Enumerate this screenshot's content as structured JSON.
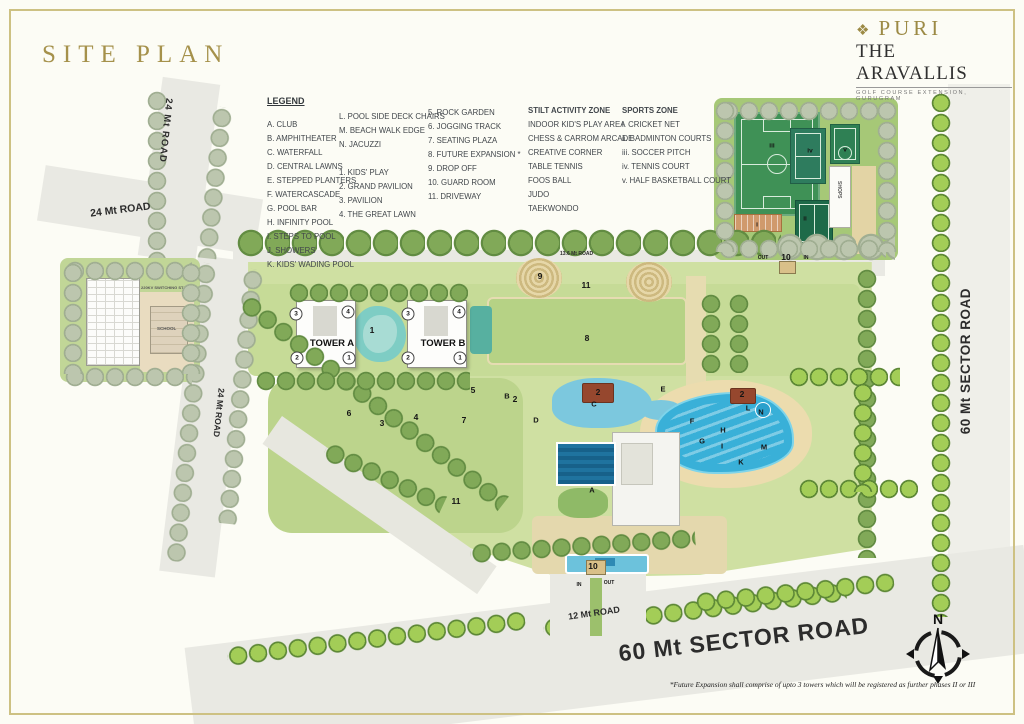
{
  "page": {
    "title": "SITE PLAN"
  },
  "brand": {
    "name": "PURI",
    "project": "THE ARAVALLIS",
    "tagline": "GOLF COURSE EXTENSION, GURUGRAM",
    "diamond": "❖"
  },
  "legend": {
    "title": "LEGEND",
    "col_letters": [
      "A. CLUB",
      "B. AMPHITHEATER",
      "C. WATERFALL",
      "D. CENTRAL LAWNS",
      "E. STEPPED PLANTERS",
      "F. WATERCASCADE",
      "G. POOL BAR",
      "H. INFINITY POOL",
      "I. STEPS TO POOL",
      "J. SHOWERS",
      "K. KIDS' WADING POOL"
    ],
    "col_letters2": [
      "L. POOL SIDE  DECK CHAIRS",
      "M. BEACH WALK EDGE",
      "N. JACUZZI"
    ],
    "col_numbers1": [
      "1.  KIDS' PLAY",
      "2.  GRAND PAVILION",
      "3.  PAVILION",
      "4.  THE GREAT LAWN"
    ],
    "col_numbers2": [
      "5.  ROCK GARDEN",
      "6.  JOGGING TRACK",
      "7.  SEATING PLAZA",
      "8.  FUTURE EXPANSION *",
      "9.  DROP OFF",
      "10. GUARD ROOM",
      "11. DRIVEWAY"
    ],
    "stilt": {
      "title": "STILT ACTIVITY ZONE",
      "items": [
        "INDOOR KID'S PLAY AREA",
        "CHESS & CARROM ARCADE",
        "CREATIVE CORNER",
        "TABLE TENNIS",
        "FOOS BALL",
        "JUDO",
        "TAEKWONDO"
      ]
    },
    "sports": {
      "title": "SPORTS ZONE",
      "items": [
        "i.   CRICKET NET",
        "ii.  BADMINTON COURTS",
        "iii. SOCCER PITCH",
        "iv.  TENNIS COURT",
        "v.   HALF BASKETBALL COURT"
      ]
    }
  },
  "roads": {
    "r24_top": "24 Mt ROAD",
    "r24_diag": "24 Mt ROAD",
    "r24_mid": "24 Mt ROAD",
    "r60_right": "60 Mt SECTOR ROAD",
    "r60_bottom": "60 Mt SECTOR ROAD",
    "r12": "12 Mt ROAD",
    "r136": "13.6 Mt ROAD"
  },
  "map": {
    "tower_a": "TOWER A",
    "tower_b": "TOWER B",
    "shops": "SHOPS",
    "switching_station": "220KV SWITCHING STATION",
    "school": "SCHOOL",
    "markers": [
      {
        "x": 296,
        "y": 314,
        "t": "3",
        "k": "c"
      },
      {
        "x": 348,
        "y": 312,
        "t": "4",
        "k": "c"
      },
      {
        "x": 297,
        "y": 358,
        "t": "2",
        "k": "c"
      },
      {
        "x": 349,
        "y": 358,
        "t": "1",
        "k": "c"
      },
      {
        "x": 408,
        "y": 314,
        "t": "3",
        "k": "c"
      },
      {
        "x": 459,
        "y": 312,
        "t": "4",
        "k": "c"
      },
      {
        "x": 408,
        "y": 358,
        "t": "2",
        "k": "c"
      },
      {
        "x": 460,
        "y": 358,
        "t": "1",
        "k": "c"
      },
      {
        "x": 372,
        "y": 330,
        "t": "1",
        "k": "n"
      },
      {
        "x": 540,
        "y": 276,
        "t": "9",
        "k": "n"
      },
      {
        "x": 586,
        "y": 285,
        "t": "11",
        "k": "n"
      },
      {
        "x": 587,
        "y": 338,
        "t": "8",
        "k": "n"
      },
      {
        "x": 349,
        "y": 413,
        "t": "6",
        "k": "n"
      },
      {
        "x": 416,
        "y": 417,
        "t": "4",
        "k": "n"
      },
      {
        "x": 464,
        "y": 420,
        "t": "7",
        "k": "n"
      },
      {
        "x": 473,
        "y": 390,
        "t": "5",
        "k": "n"
      },
      {
        "x": 456,
        "y": 501,
        "t": "11",
        "k": "n"
      },
      {
        "x": 382,
        "y": 423,
        "t": "3",
        "k": "n"
      },
      {
        "x": 515,
        "y": 399,
        "t": "2",
        "k": "n"
      },
      {
        "x": 598,
        "y": 392,
        "t": "2",
        "k": "n"
      },
      {
        "x": 742,
        "y": 394,
        "t": "2",
        "k": "n"
      },
      {
        "x": 593,
        "y": 566,
        "t": "10",
        "k": "n"
      },
      {
        "x": 786,
        "y": 257,
        "t": "10",
        "k": "n"
      },
      {
        "x": 507,
        "y": 396,
        "t": "B",
        "k": "l"
      },
      {
        "x": 594,
        "y": 404,
        "t": "C",
        "k": "l"
      },
      {
        "x": 536,
        "y": 420,
        "t": "D",
        "k": "l"
      },
      {
        "x": 663,
        "y": 389,
        "t": "E",
        "k": "l"
      },
      {
        "x": 692,
        "y": 421,
        "t": "F",
        "k": "l"
      },
      {
        "x": 702,
        "y": 441,
        "t": "G",
        "k": "l"
      },
      {
        "x": 723,
        "y": 430,
        "t": "H",
        "k": "l"
      },
      {
        "x": 722,
        "y": 446,
        "t": "I",
        "k": "l"
      },
      {
        "x": 741,
        "y": 462,
        "t": "K",
        "k": "l"
      },
      {
        "x": 748,
        "y": 408,
        "t": "L",
        "k": "l"
      },
      {
        "x": 764,
        "y": 447,
        "t": "M",
        "k": "l"
      },
      {
        "x": 761,
        "y": 412,
        "t": "N",
        "k": "l"
      },
      {
        "x": 592,
        "y": 490,
        "t": "A",
        "k": "l"
      },
      {
        "x": 763,
        "y": 258,
        "t": "OUT",
        "k": "g"
      },
      {
        "x": 806,
        "y": 258,
        "t": "IN",
        "k": "g"
      },
      {
        "x": 579,
        "y": 585,
        "t": "IN",
        "k": "g"
      },
      {
        "x": 609,
        "y": 583,
        "t": "OUT",
        "k": "g"
      },
      {
        "x": 772,
        "y": 146,
        "t": "iii",
        "k": "r"
      },
      {
        "x": 810,
        "y": 151,
        "t": "iv",
        "k": "r"
      },
      {
        "x": 845,
        "y": 150,
        "t": "v",
        "k": "r"
      },
      {
        "x": 805,
        "y": 219,
        "t": "ii",
        "k": "r"
      },
      {
        "x": 757,
        "y": 225,
        "t": "i",
        "k": "r"
      }
    ]
  },
  "compass": {
    "n": "N"
  },
  "footnote": "*Future Expansion shall comprise of upto 3 towers which will be registered as further  phases II or III",
  "colors": {
    "gold": "#a5914b",
    "frame": "#cdc183",
    "site_green": "#cfe0a2",
    "pool_blue": "#39b0d8"
  }
}
